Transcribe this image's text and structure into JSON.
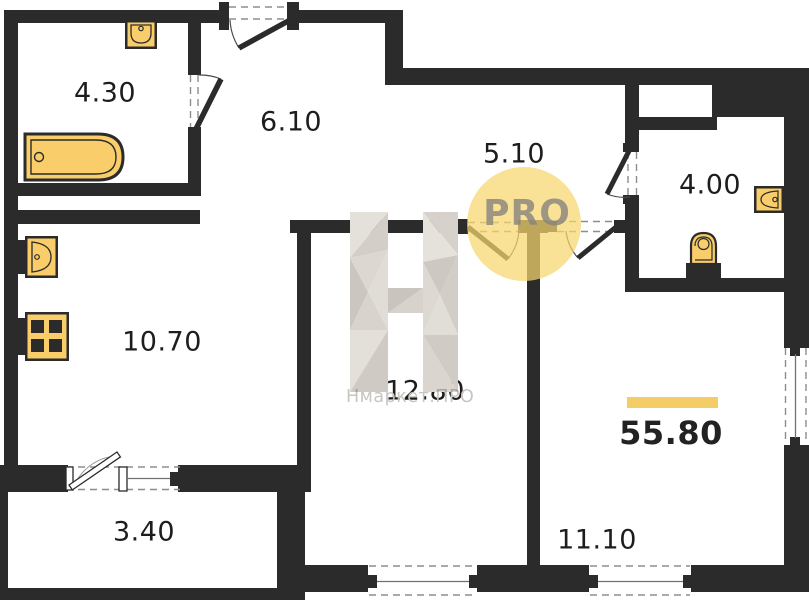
{
  "plan": {
    "total_area": "55.80",
    "rooms": [
      {
        "name": "bathroom",
        "area": "4.30"
      },
      {
        "name": "hallway",
        "area": "6.10"
      },
      {
        "name": "corridor",
        "area": "5.10"
      },
      {
        "name": "wc",
        "area": "4.00"
      },
      {
        "name": "kitchen",
        "area": "10.70"
      },
      {
        "name": "bedroom",
        "area": "12.80"
      },
      {
        "name": "living-room",
        "area": "11.10"
      },
      {
        "name": "balcony",
        "area": "3.40"
      }
    ],
    "fixtures": [
      "bathtub-icon",
      "sink-icon",
      "kitchen-sink-icon",
      "stove-icon",
      "toilet-icon",
      "washbasin-icon"
    ],
    "colors": {
      "wall": "#2b2b2b",
      "fixture_fill": "#f8cd6a",
      "accent_bar": "#f5cd66",
      "watermark_circle": "#f7d56d",
      "watermark_gray": "#d8d4ce",
      "label": "#1d1d1d"
    }
  },
  "watermark": {
    "logo_letter": "Н",
    "brand": "Нмаркет.ПРО",
    "badge": "PRO"
  }
}
